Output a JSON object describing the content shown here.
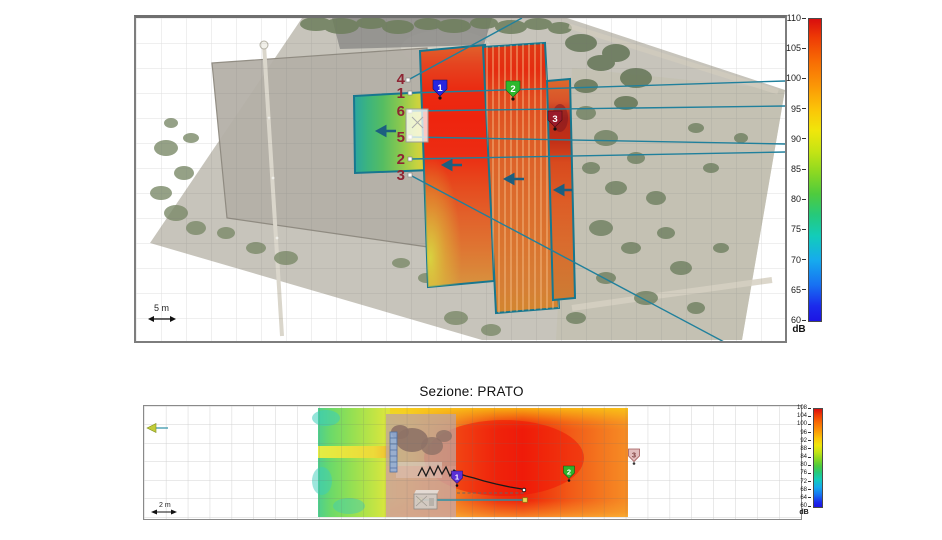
{
  "section_view_title": "Sezione: PRATO",
  "top_map": {
    "scale_label": "5 m",
    "section_line_labels": [
      "4",
      "1",
      "6",
      "5",
      "2",
      "3"
    ],
    "receivers": [
      {
        "label": "1",
        "color": "#2626e0"
      },
      {
        "label": "2",
        "color": "#2db82d"
      },
      {
        "label": "3",
        "color": "#9a1a2a"
      }
    ],
    "colorbar": {
      "unit": "dB",
      "min": 60,
      "max": 110,
      "ticks": [
        110,
        105,
        100,
        95,
        90,
        85,
        80,
        75,
        70,
        65,
        60
      ]
    }
  },
  "section_view": {
    "scale_label": "2 m",
    "receivers": [
      {
        "label": "1",
        "color": "#5b2fd4"
      },
      {
        "label": "2",
        "color": "#2db22d"
      },
      {
        "label": "3",
        "color": "#e2bdbd"
      }
    ],
    "colorbar": {
      "unit": "dB",
      "min": 60,
      "max": 108,
      "ticks": [
        108,
        104,
        100,
        96,
        92,
        88,
        84,
        80,
        76,
        72,
        68,
        64,
        60
      ]
    }
  },
  "colors": {
    "section_line": "#20809c",
    "grid_border": "#17778f",
    "label_red": "#8e2433",
    "arrow_teal": "#1c5f80"
  }
}
